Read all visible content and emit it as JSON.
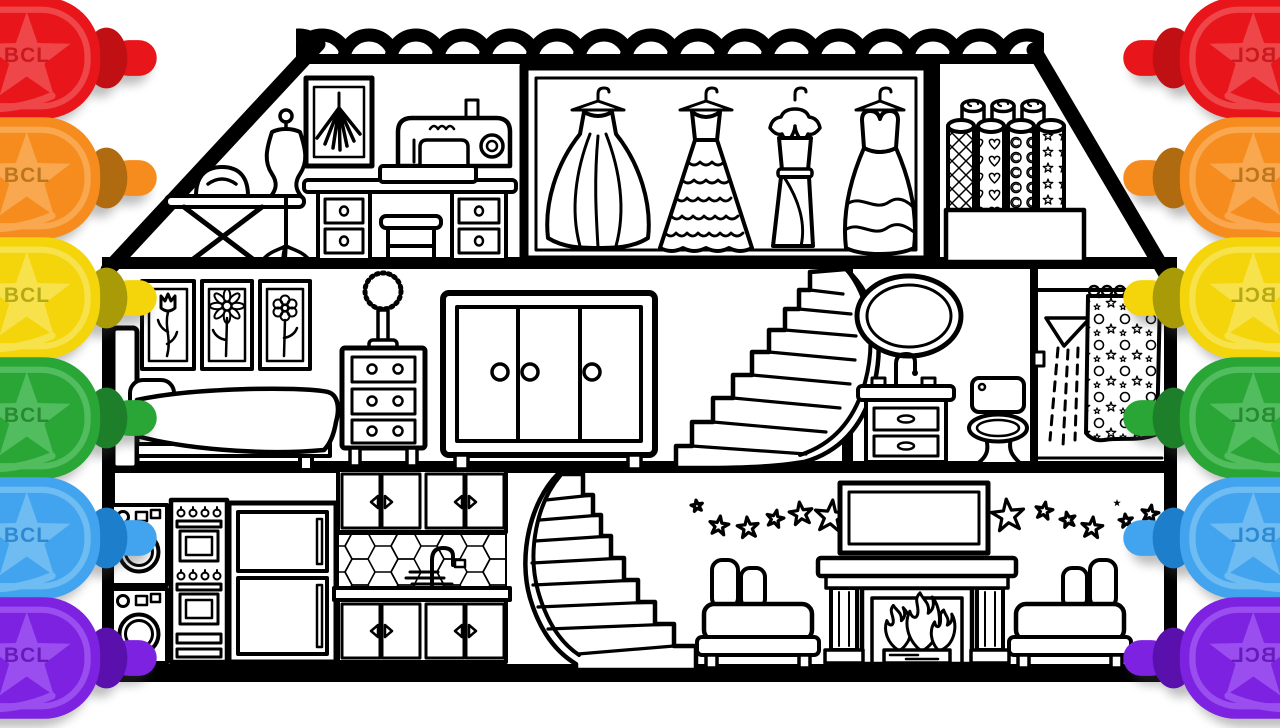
{
  "palette": {
    "line": "#000000",
    "background": "#ffffff"
  },
  "markers": {
    "label": "BCL",
    "side_left": [
      "red",
      "orange",
      "yellow",
      "green",
      "blue",
      "purple"
    ],
    "side_right": [
      "red",
      "orange",
      "yellow",
      "green",
      "blue",
      "purple"
    ],
    "colors": {
      "red": {
        "main": "#e8151b",
        "dark": "#c11014",
        "light": "#ef4649"
      },
      "orange": {
        "main": "#f68b1e",
        "dark": "#b06a10",
        "light": "#f9a84f"
      },
      "yellow": {
        "main": "#f4d40a",
        "dark": "#a89b07",
        "light": "#f7e24c"
      },
      "green": {
        "main": "#2aa637",
        "dark": "#1e7f2a",
        "light": "#52bd5e"
      },
      "blue": {
        "main": "#42a4ee",
        "dark": "#1d7ecb",
        "light": "#6fbcf3"
      },
      "purple": {
        "main": "#7d22e0",
        "dark": "#5a10ad",
        "light": "#9a4ef0"
      }
    }
  },
  "scene": {
    "type": "coloring-page-line-art",
    "subject": "dollhouse-cutaway",
    "roof": "scalloped-tile-ridge",
    "floors": [
      {
        "name": "attic",
        "rooms": [
          {
            "name": "sewing-room",
            "items": [
              "ironing-board",
              "iron",
              "dress-mannequin",
              "attic-picture",
              "sewing-machine",
              "sewing-desk",
              "stool"
            ]
          },
          {
            "name": "dress-closet",
            "items": [
              "ball-gown",
              "tiered-gown",
              "ruffle-collar-dress",
              "heart-bodice-gown"
            ]
          },
          {
            "name": "fabric-storage",
            "items": [
              "fabric-roll-diamond",
              "fabric-roll-hearts",
              "fabric-roll-moons",
              "fabric-roll-stars",
              "storage-box"
            ]
          }
        ]
      },
      {
        "name": "second-floor",
        "rooms": [
          {
            "name": "bedroom",
            "items": [
              "tulip-picture",
              "daisy-picture",
              "flower-picture",
              "bed",
              "pillow",
              "blanket",
              "nightstand",
              "fuzzy-lamp"
            ]
          },
          {
            "name": "landing",
            "items": [
              "wardrobe",
              "curved-staircase-upper"
            ]
          },
          {
            "name": "bathroom",
            "items": [
              "oval-mirror",
              "sink-vanity",
              "faucet",
              "toilet"
            ]
          },
          {
            "name": "shower-room",
            "items": [
              "shower-head",
              "water-spray",
              "curtain-rod",
              "patterned-shower-curtain"
            ]
          }
        ]
      },
      {
        "name": "ground-floor",
        "rooms": [
          {
            "name": "kitchen",
            "items": [
              "washing-machine-top",
              "washing-machine-bottom",
              "double-oven",
              "refrigerator",
              "upper-cabinets",
              "hex-tile-backsplash",
              "kitchen-faucet",
              "counter",
              "lower-cabinets"
            ]
          },
          {
            "name": "stairwell",
            "items": [
              "curved-staircase-lower"
            ]
          },
          {
            "name": "living-room",
            "items": [
              "star-garland-left",
              "television",
              "fireplace",
              "fire",
              "logs",
              "armchair-left",
              "armchair-right",
              "star-garland-right"
            ]
          }
        ]
      }
    ]
  }
}
